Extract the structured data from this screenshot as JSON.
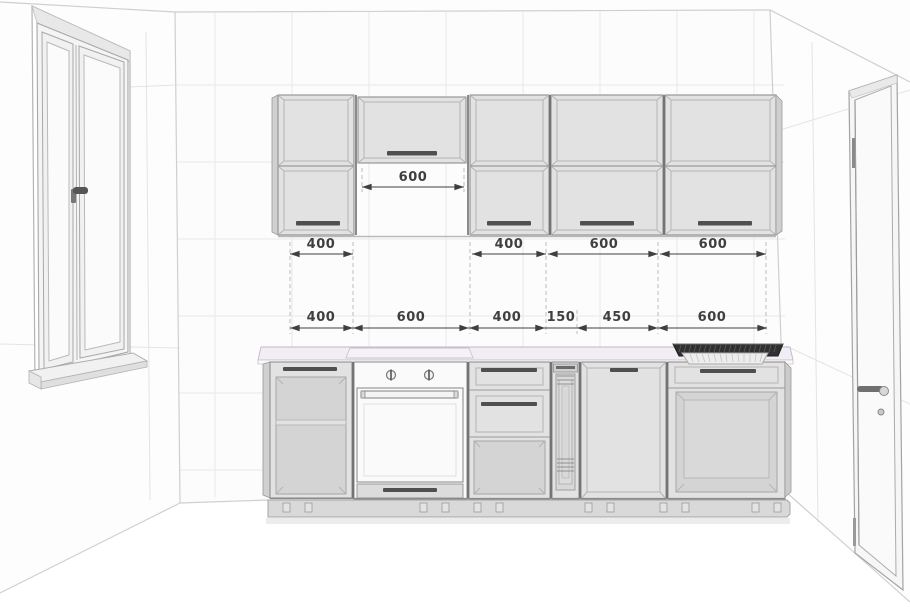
{
  "dimensions": {
    "hood_gap": {
      "label": "600"
    },
    "upper_row": [
      {
        "label": "400"
      },
      {
        "label": "400"
      },
      {
        "label": "600"
      },
      {
        "label": "600"
      }
    ],
    "base_row": [
      {
        "label": "400"
      },
      {
        "label": "600"
      },
      {
        "label": "400"
      },
      {
        "label": "150"
      },
      {
        "label": "450"
      },
      {
        "label": "600"
      }
    ]
  },
  "colors": {
    "dimension_text": "#3f3f3f",
    "cabinet_face": "#e2e2e2",
    "cabinet_interior": "#d4d4d4",
    "appliance_white": "#fafafa",
    "countertop": "#f2ecf5",
    "sink_basin": "#303030",
    "plinth": "#d9d9d9",
    "wall": "#fcfcfc",
    "tile_line": "#e9e9e9"
  }
}
